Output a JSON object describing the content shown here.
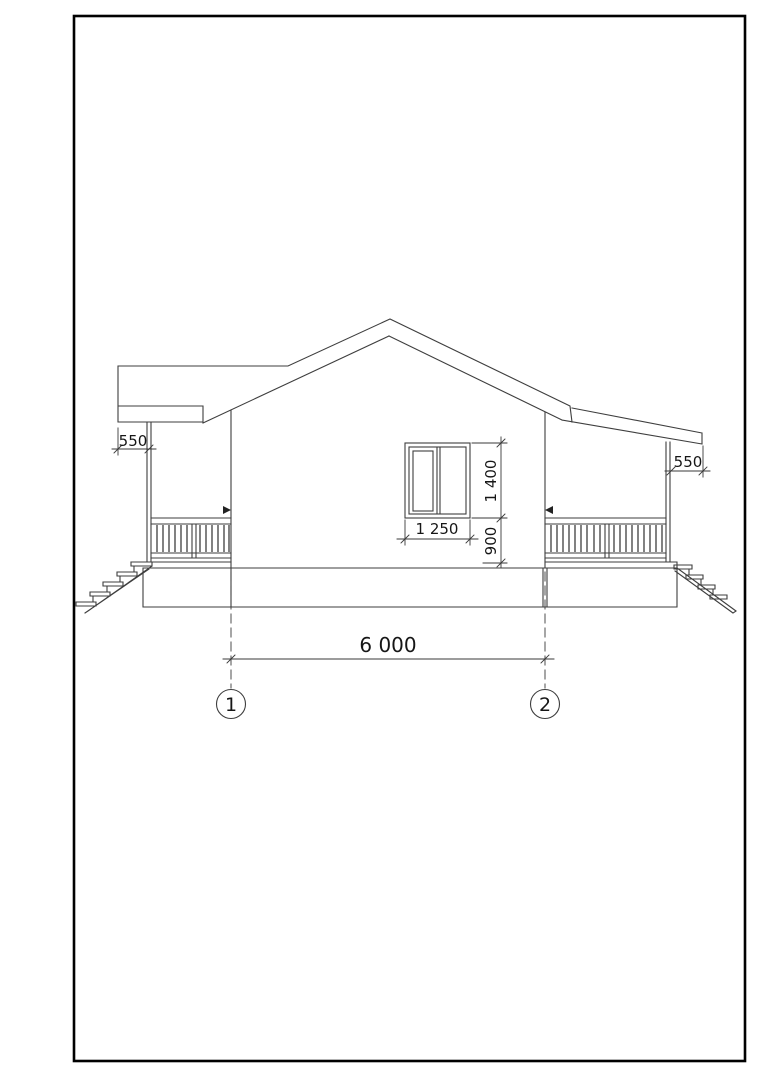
{
  "drawing": {
    "type": "house-side-elevation-blueprint",
    "dimension_labels": {
      "left_eave_overhang": "550",
      "right_eave_overhang": "550",
      "window_width": "1 250",
      "window_height": "1 400",
      "window_sill_height": "900",
      "axis_span": "6 000"
    },
    "axis_markers": [
      {
        "label": "1"
      },
      {
        "label": "2"
      }
    ],
    "colors": {
      "line": "#3e3e3e",
      "text": "#161616",
      "frame": "#000000",
      "background": "#ffffff"
    }
  }
}
